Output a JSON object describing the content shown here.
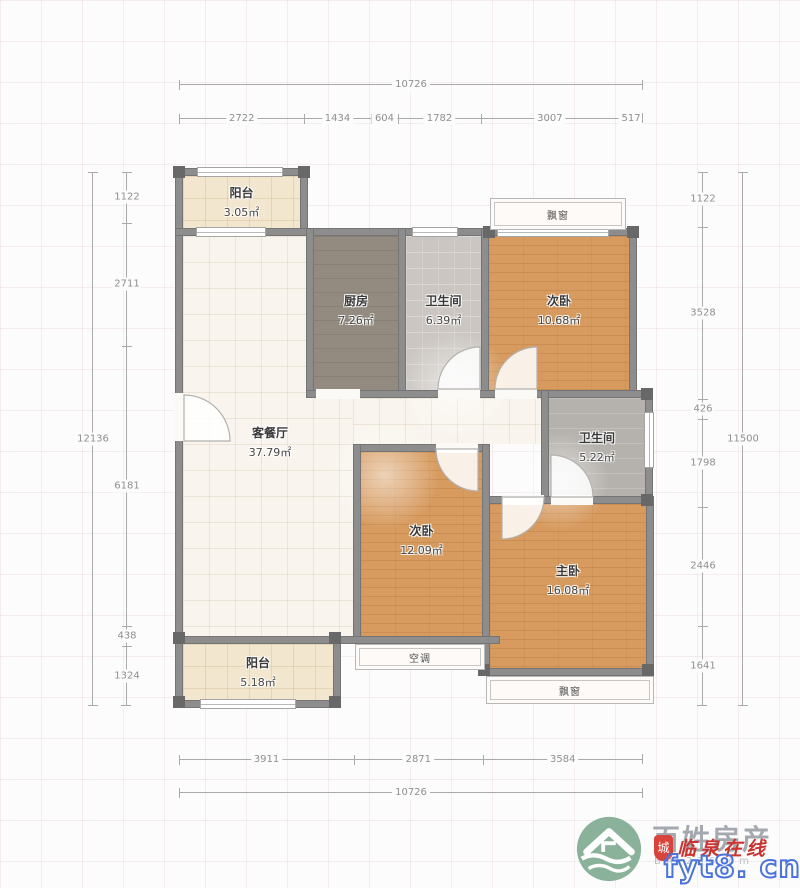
{
  "rooms": {
    "balcony_top": {
      "name": "阳台",
      "area": "3.05㎡"
    },
    "kitchen": {
      "name": "厨房",
      "area": "7.26㎡"
    },
    "bath_top": {
      "name": "卫生间",
      "area": "6.39㎡"
    },
    "bedroom_top": {
      "name": "次卧",
      "area": "10.68㎡"
    },
    "living": {
      "name": "客餐厅",
      "area": "37.79㎡"
    },
    "bath_mid": {
      "name": "卫生间",
      "area": "5.22㎡"
    },
    "bedroom_mid": {
      "name": "次卧",
      "area": "12.09㎡"
    },
    "master": {
      "name": "主卧",
      "area": "16.08㎡"
    },
    "balcony_bottom": {
      "name": "阳台",
      "area": "5.18㎡"
    }
  },
  "features": {
    "bay_top": "飘窗",
    "ac_platform": "空调",
    "bay_bottom": "飘窗"
  },
  "dimensions": {
    "top_total": "10726",
    "top_segments": [
      "2722",
      "1434",
      "604",
      "1782",
      "3007",
      "517"
    ],
    "bottom_segments": [
      "3911",
      "2871",
      "3584"
    ],
    "bottom_total": "10726",
    "left_total": "12136",
    "left_segments": [
      "1122",
      "2711",
      "6181",
      "438",
      "1324"
    ],
    "right_segments": [
      "1122",
      "3528",
      "426",
      "1798",
      "2446",
      "1641"
    ],
    "right_total": "11500"
  },
  "watermark": {
    "brand": "百姓房产",
    "brand_sub": "BA 236 om",
    "stamp_badge": "城",
    "stamp_text": "临泉在线",
    "url": "fyt8. cn"
  }
}
